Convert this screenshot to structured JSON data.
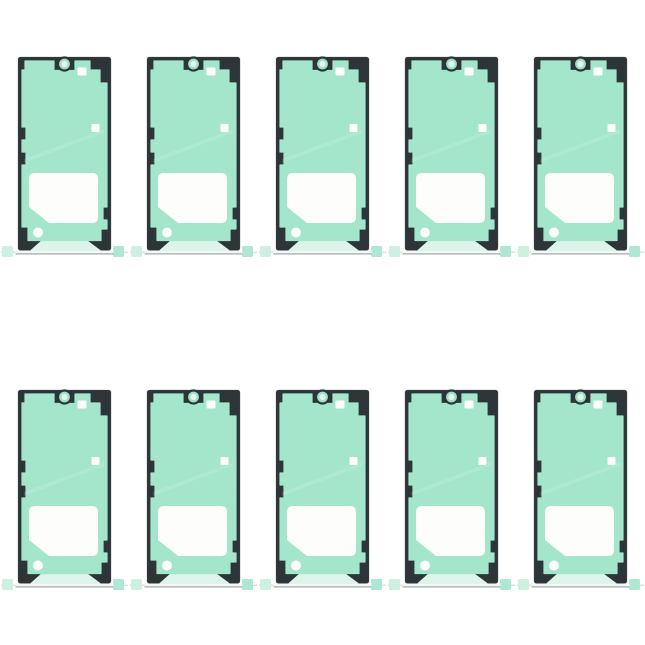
{
  "scene": {
    "subject": "pack of phone screen adhesive sticker sheets",
    "item_count": 10,
    "background": "plain white"
  },
  "layout": {
    "rows": 2,
    "columns": 5
  },
  "sheet_parts": {
    "frame": "dark-frame",
    "adhesive": "mint-adhesive-layer",
    "camera": "camera-hole-cutout",
    "top_square": "sensor-cutout-square",
    "mid_square": "component-cutout-square",
    "window": "lower-window-cutout",
    "dot": "round-hole-cutout",
    "strip": "bottom-adhesive-strip",
    "tab_left": "pull-tab-left",
    "tab_right": "pull-tab-right",
    "liner": "liner-edge-strip"
  },
  "palette": {
    "bg": "#ffffff",
    "frame": "#2d3539",
    "frame_edge": "#4d585b",
    "green": "#a3e6cc",
    "ring_green": "#9ce2c6",
    "cam_center": "#e8f3ee",
    "cutout": "#fdfdfc",
    "strip": "#ddf4ea",
    "liner": "#f6f8f7",
    "liner_line": "#b4b8b9",
    "connector": "#c9cdcc",
    "tab": "#aee8d2",
    "tab_light": "#ccf1e1"
  }
}
